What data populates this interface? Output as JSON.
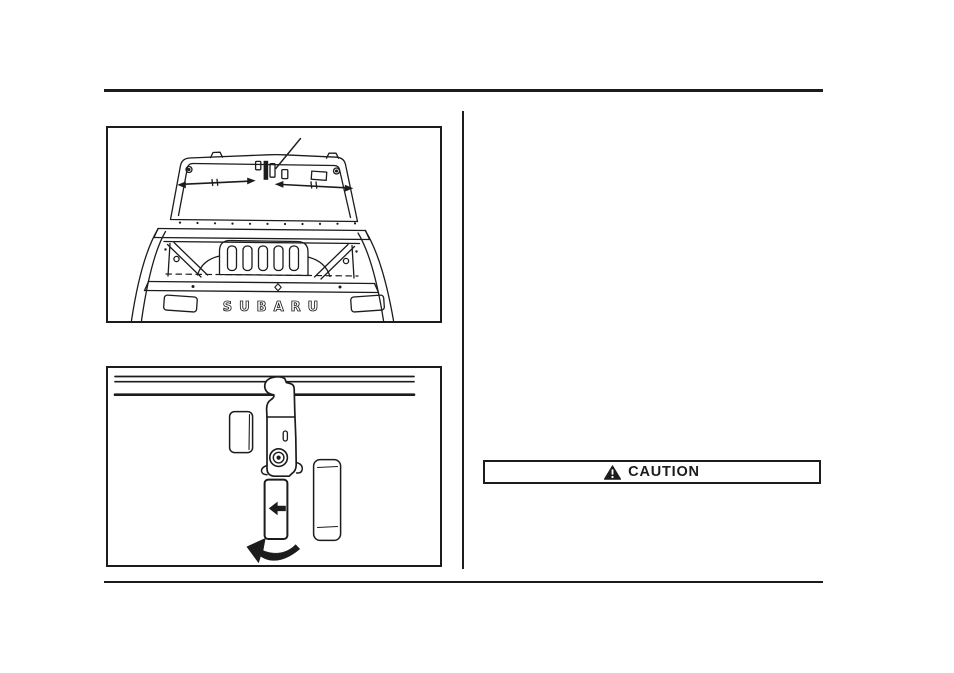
{
  "page": {
    "background_color": "#ffffff",
    "ink_color": "#1c1c1c"
  },
  "layout": {
    "header_rule": "header-rule",
    "footer_rule": "footer-rule",
    "column_divider": "column-divider"
  },
  "figure_rear_gate": {
    "description": "line drawing of vehicle rear gate window with latch callout",
    "badge_text": "SUBARU",
    "icons": {
      "callout": "callout-leader-line",
      "left_strut": "double-headed-arrow-icon",
      "right_strut": "double-headed-arrow-icon"
    }
  },
  "figure_latch": {
    "description": "line drawing of window latch hook and handle",
    "icons": {
      "slide_arrow": "left-arrow-icon",
      "rotate_arrow": "curved-rotation-arrow-icon"
    }
  },
  "caution_box": {
    "title": "CAUTION",
    "icon": "warning-triangle-icon"
  }
}
